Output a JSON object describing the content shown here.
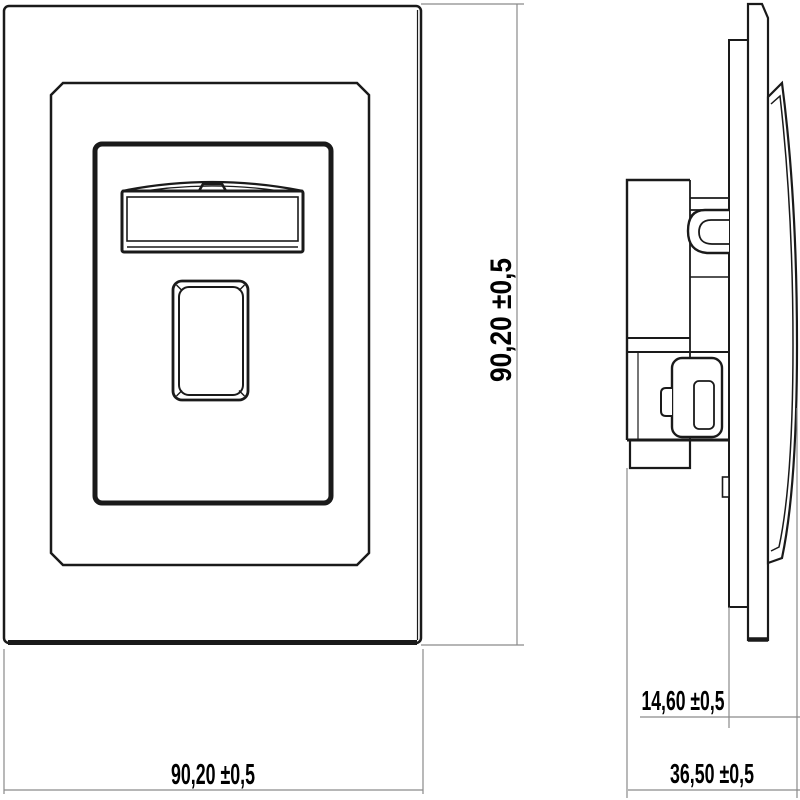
{
  "drawing": {
    "labels": {
      "front_width": "90,20 ±0,5",
      "front_height": "90,20 ±0,5",
      "side_protrusion_depth": "14,60 ±0,5",
      "side_total_depth": "36,50 ±0,5"
    },
    "colors": {
      "line": "#1a1a1a",
      "dim_line": "#8a8a8a",
      "text": "#000000",
      "background": "#ffffff"
    }
  }
}
